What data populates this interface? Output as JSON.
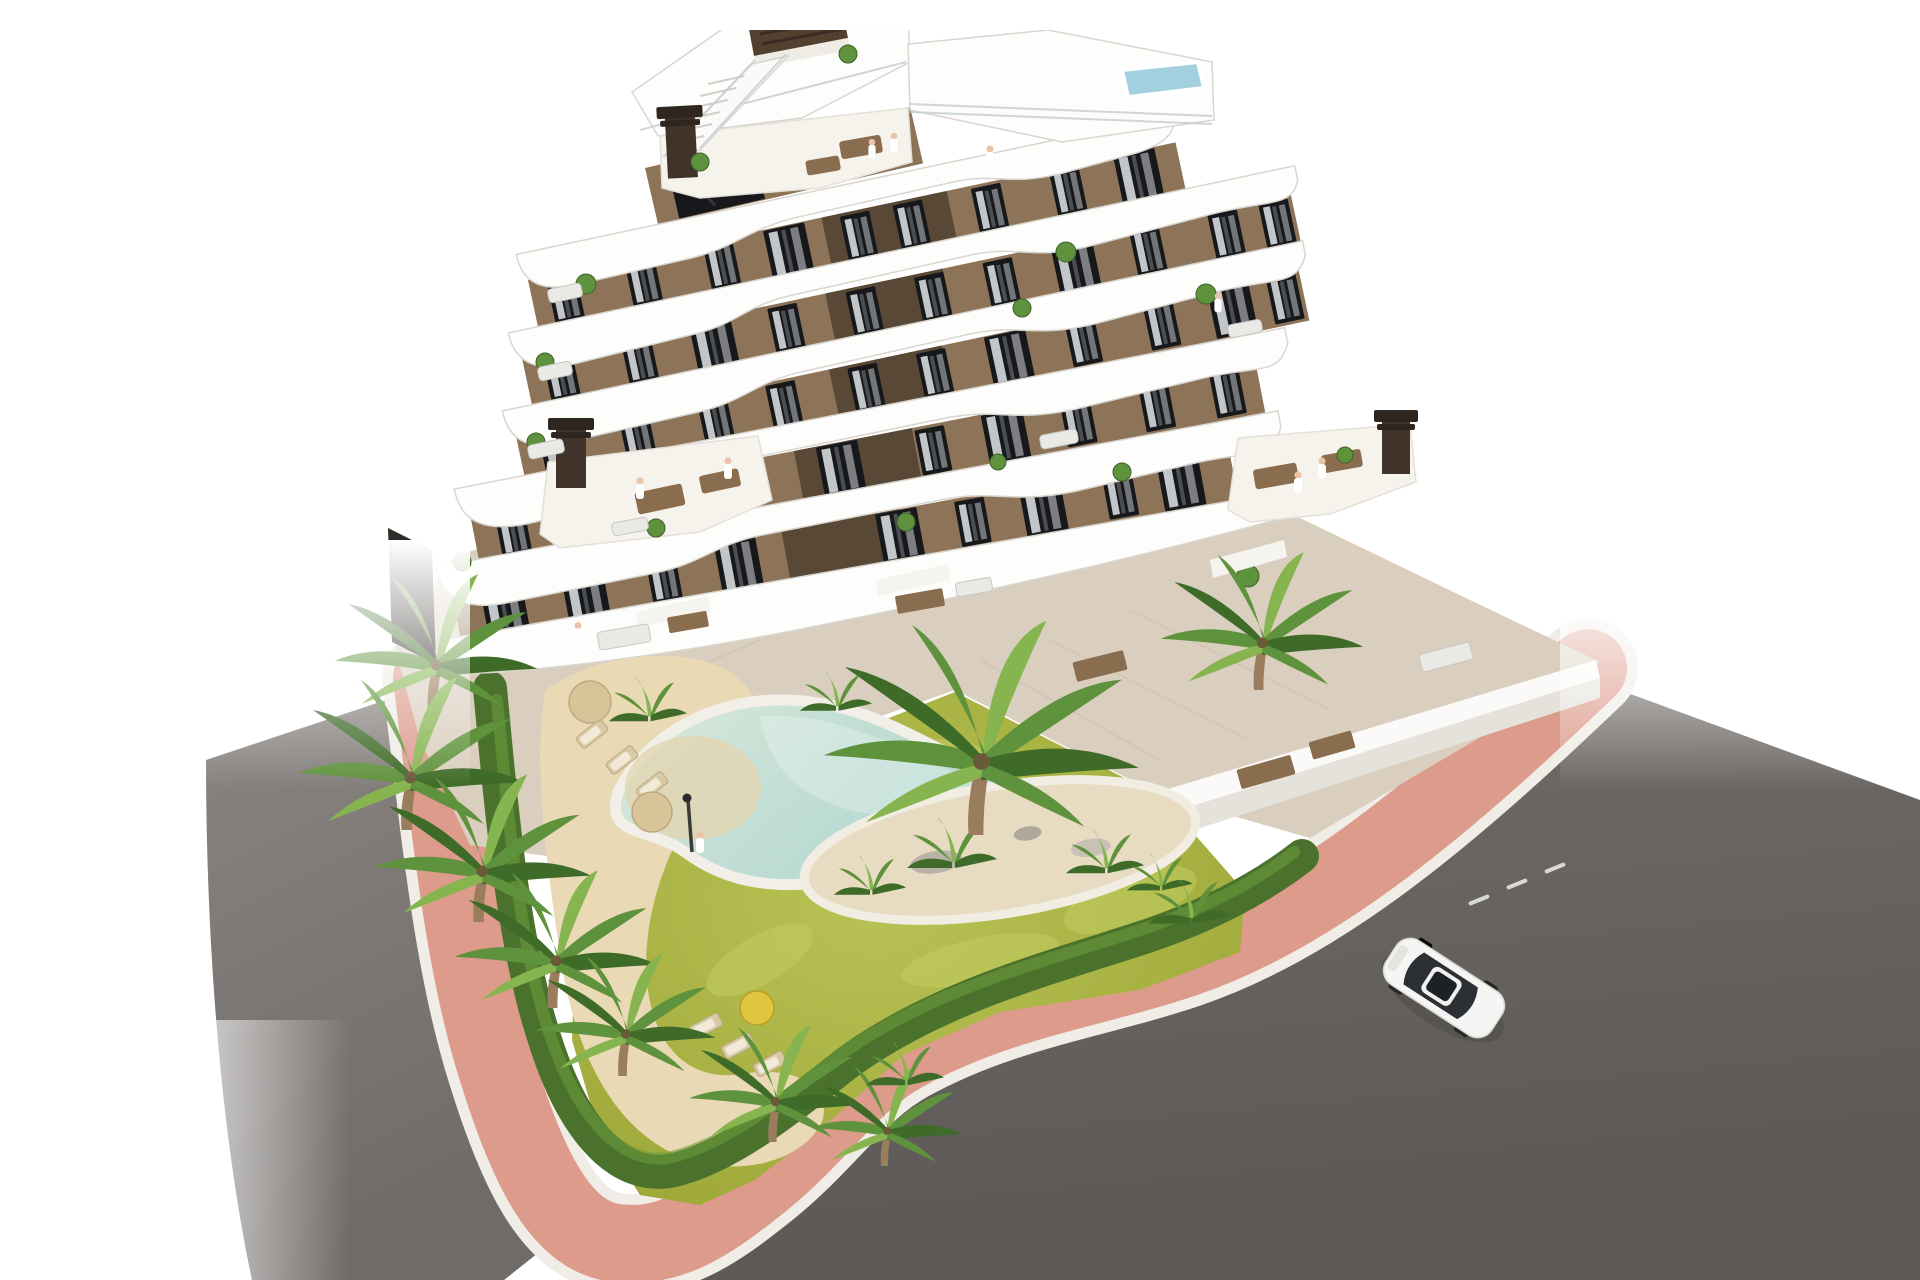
{
  "scene": {
    "type": "architectural-3d-render",
    "subject": "aerial view of a modern white-and-brown apartment building with curved balcony bands, landscaped garden, free-form pool and street corner",
    "floors_visible": 7,
    "time_of_day": "daylight",
    "background": "white studio fade"
  },
  "objects": {
    "building": "stepped apartment block with wavy white balcony slabs and brown facades",
    "rooftop": "roof terrace with plunge pool, roof access structure and external staircase",
    "garden": "lawn with planted island, hedges and palm trees",
    "pool": "free-form swimming pool with sandy beach entry",
    "street": "corner of two asphalt roads with pink paved sidewalk",
    "vehicle": "white car driving on right road",
    "amenities": "sun loungers, parasols, outdoor dining sets, garden lamp"
  },
  "counts": {
    "pools": 2,
    "cars": 1,
    "parasols": 3,
    "sun_loungers": 6,
    "chimneys": 4,
    "people_visible": 9,
    "large_palms": 10
  },
  "colors": {
    "background": "#ffffff",
    "slabWhite": "#fdfdfb",
    "slabShadow": "#d9d6d0",
    "facade": "#8d7458",
    "facadeShadow": "#6e5a42",
    "facadeDark": "#5a4836",
    "windowGlass": "#17181b",
    "curtain": "#e4e7e9",
    "roadLeft": "#7d7875",
    "roadRight": "#656off",
    "roadRightFix": "#656360",
    "sidewalkPink": "#dd9b8c",
    "curbWhite": "#f0ede7",
    "lawn": "#a9b23c",
    "lawnLight": "#c3cc62",
    "hedge": "#4a722c",
    "palm": "#5f923c",
    "palmDark": "#3f6b28",
    "palmLight": "#86b550",
    "sand": "#e9d9b5",
    "poolWater": "#c3dfd6",
    "poolShallow": "#ddeadc",
    "rooftopPool": "#a3d0de",
    "pavement": "#dacfbf",
    "wallWhite": "#fbfaf8",
    "woodFurniture": "#8a6c4e",
    "carBody": "#f5f5f3",
    "carGlass": "#2c2f34",
    "fence": "#302c28",
    "lampPost": "#3a3a38",
    "parasolTan": "#d9c49a",
    "parasolYellow": "#e0c63e"
  }
}
